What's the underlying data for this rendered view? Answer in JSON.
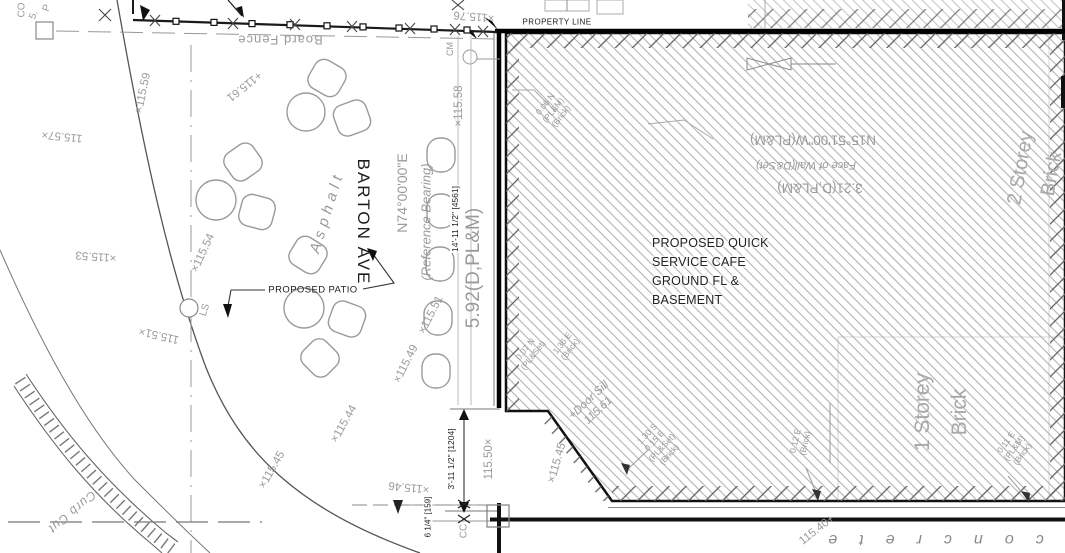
{
  "labels": {
    "street_name": "BARTON AVE",
    "reference_bearing": "N74°00'00\"E",
    "reference_bearing_note": "(Reference Bearing)",
    "board_fence": "Board Fence",
    "property_line": "PROPERTY LINE",
    "proposed_patio": "PROPOSED PATIO",
    "asphalt": "Asphalt",
    "concrete": "concrete",
    "curb_cut": "Curb Cut",
    "lamp_standard": "LS",
    "cc_marker": "CC",
    "cm_marker": "CM",
    "corner_partials": [
      "CO",
      "5.",
      "P"
    ]
  },
  "building": {
    "use_lines": [
      "PROPOSED QUICK",
      "SERVICE CAFE",
      "GROUND FL &",
      "BASEMENT"
    ],
    "north_wall": {
      "bearing": "N15°51'00\"W(PL&M)",
      "face": "Face of Wall(D&Set)",
      "length": "3.21(D,PL&M)"
    },
    "storey_1": {
      "line1": "1 Storey",
      "line2": "Brick"
    },
    "storey_2": {
      "line1": "2 Storey",
      "line2": "Brick"
    },
    "door_sill": {
      "line1": "+Door Sill",
      "line2": "115.61"
    }
  },
  "dimensions": {
    "west_wall_imperial": "14'-11 1/2\" [4561]",
    "west_wall_metric": "5.92(D,PL&M)",
    "patio_imperial": "3'-11 1/2\" [1204]",
    "sill_offset": "6 1/4\" [159]"
  },
  "offsets": [
    {
      "lines": [
        "0.06 N",
        "(PL&M)",
        "(Brick)"
      ]
    },
    {
      "lines": [
        "0.07 N",
        "(PL&Set)"
      ]
    },
    {
      "lines": [
        "1.36 E",
        "(Brick)"
      ]
    },
    {
      "lines": [
        "1.30 S",
        "0.15 E",
        "(PL&Set)",
        "(Brick)"
      ]
    },
    {
      "lines": [
        "0.12 E",
        "(Brick)"
      ]
    },
    {
      "lines": [
        "0.11 E",
        "(PL&M)",
        "(Brick)"
      ]
    }
  ],
  "spot_elevations": [
    "×115.59",
    "115.57×",
    "+115.61",
    "×115.53",
    "×115.54",
    "115.51×",
    "×115.51",
    "×115.49",
    "×115.58",
    "×115.76",
    "115.50×",
    "×115.46",
    "×115.44",
    "×115.45",
    "×115.45",
    "115.40+"
  ]
}
